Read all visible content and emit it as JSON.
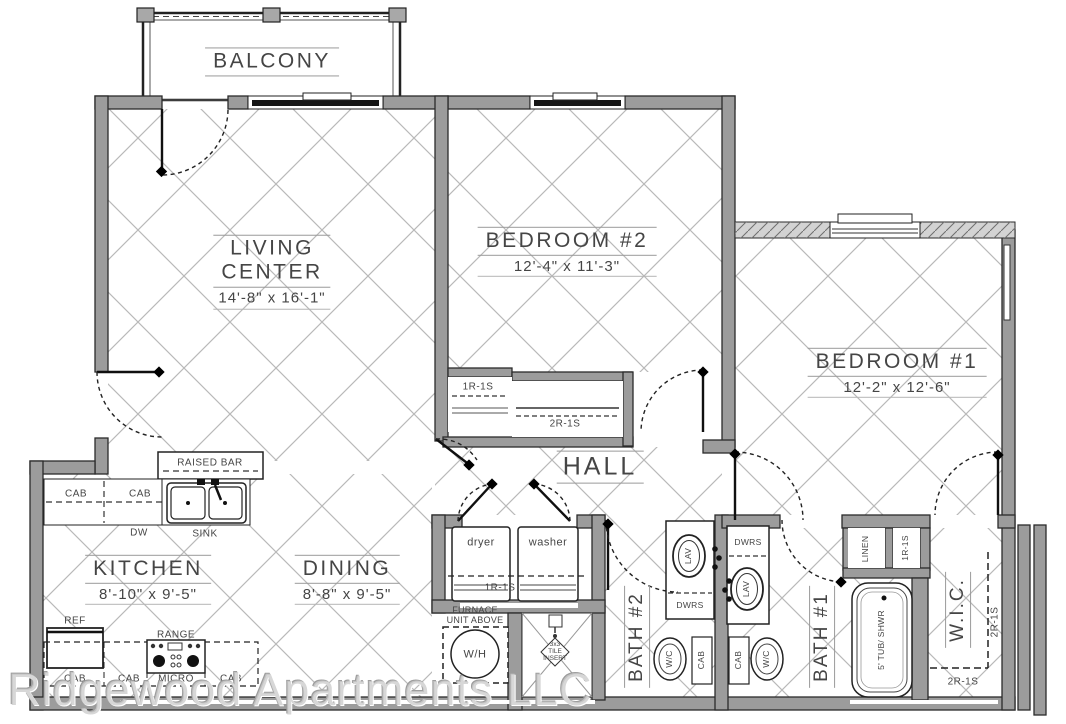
{
  "watermark": "Ridgewood Apartments LLC",
  "rooms": {
    "balcony": {
      "name": "BALCONY"
    },
    "living": {
      "line1": "LIVING",
      "line2": "CENTER",
      "dims": "14'-8\" x 16'-1\""
    },
    "bedroom2": {
      "name": "BEDROOM #2",
      "dims": "12'-4\" x 11'-3\""
    },
    "bedroom1": {
      "name": "BEDROOM #1",
      "dims": "12'-2\" x 12'-6\""
    },
    "hall": {
      "name": "HALL"
    },
    "kitchen": {
      "name": "KITCHEN",
      "dims": "8'-10\" x 9'-5\""
    },
    "dining": {
      "name": "DINING",
      "dims": "8'-8\" x 9'-5\""
    },
    "bath2": {
      "name": "BATH #2"
    },
    "bath1": {
      "name": "BATH #1"
    },
    "wic": {
      "name": "W.I.C."
    }
  },
  "kitchen": {
    "raised_bar": "RAISED BAR",
    "cab_upper_1": "CAB",
    "cab_upper_2": "CAB",
    "dw": "DW",
    "sink": "SINK",
    "ref": "REF",
    "range": "RANGE",
    "micro": "MICRO",
    "cab_lower_1": "CAB",
    "cab_lower_2": "CAB",
    "cab_lower_3": "CAB"
  },
  "laundry": {
    "dryer": "dryer",
    "washer": "washer",
    "shelf": "1R-1S"
  },
  "utility": {
    "furnace_line1": "FURNACE",
    "furnace_line2": "UNIT ABOVE",
    "water_heater": "W/H",
    "tile_line1": "3x3",
    "tile_line2": "TILE",
    "tile_line3": "INSERT"
  },
  "bath": {
    "lav1": "LAV",
    "lav2": "LAV",
    "dwrs1": "DWRS",
    "dwrs2": "DWRS",
    "wc1": "W/C",
    "wc2": "W/C",
    "cab1": "CAB",
    "cab2": "CAB",
    "tub": "5' TUB/ SHWR"
  },
  "closets": {
    "bed2_closet1": "1R-1S",
    "bed2_closet2": "2R-1S",
    "linen": "LINEN",
    "hall_closet": "1R-1S",
    "wic_side": "2R-1S",
    "wic_bottom": "2R-1S"
  },
  "colors": {
    "wall": "#9c9c9c",
    "line": "#2b2b2b",
    "hatch": "#b9b9b9"
  }
}
